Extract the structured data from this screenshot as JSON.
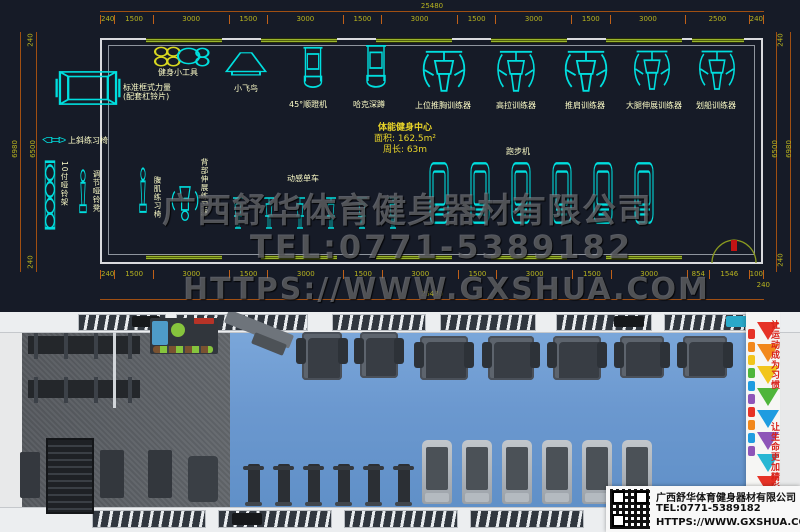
{
  "cad": {
    "dims_top": {
      "total": "25480",
      "segments": [
        "240",
        "1500",
        "3000",
        "1500",
        "3000",
        "1500",
        "3000",
        "1500",
        "3000",
        "1500",
        "3000",
        "2500",
        "240"
      ]
    },
    "dims_bottom": {
      "total": "25480",
      "segments": [
        "240",
        "1500",
        "3000",
        "1500",
        "3000",
        "1500",
        "3000",
        "1500",
        "3000",
        "1500",
        "3000",
        "854",
        "1546",
        "100"
      ],
      "corner": "240"
    },
    "dims_left": {
      "outer": "6980",
      "inner": "6500",
      "top": "240",
      "bottom": "240"
    },
    "dims_right": {
      "outer": "6980",
      "inner": "6500",
      "top": "240",
      "bottom": "240"
    },
    "center_info": {
      "name": "体能健身中心",
      "area": "面积: 162.5m²",
      "perimeter": "周长: 63m"
    },
    "equipment": {
      "top": [
        {
          "label": "标准框式力量",
          "label2": "(配套杠铃片)"
        },
        {
          "label": "健身小工具"
        },
        {
          "label": "小飞鸟"
        },
        {
          "label": "45°顺蹬机"
        },
        {
          "label": "哈克深蹲"
        },
        {
          "label": "上位推胸训练器"
        },
        {
          "label": "高拉训练器"
        },
        {
          "label": "推肩训练器"
        },
        {
          "label": "大腿伸展训练器"
        },
        {
          "label": "划船训练器"
        }
      ],
      "bottom": [
        {
          "label": "上斜练习椅"
        },
        {
          "label": "10付哑铃架"
        },
        {
          "label": "调节哑铃凳"
        },
        {
          "label": "腹肌练习椅"
        },
        {
          "label": "背部伸展练习器"
        },
        {
          "label": "动感单车"
        },
        {
          "label": "跑步机"
        }
      ]
    },
    "watermark": {
      "line1": "广西舒华体育健身器材有限公司",
      "line2": "TEL:0771-5389182",
      "line3": "HTTPS://WWW.GXSHUA.COM"
    }
  },
  "render": {
    "banner": {
      "slogan1": "让运动成为习惯",
      "slogan2": "让生命更加精彩"
    },
    "info_box": {
      "company": "广西舒华体育健身器材有限公司",
      "tel": "TEL:0771-5389182",
      "url": "HTTPS://WWW.GXSHUA.COM"
    }
  },
  "colors": {
    "cad_background": "#161b27",
    "equipment_line": "#00dede",
    "dimension_line": "#a04f12",
    "dimension_text": "#b7b31f",
    "label_text": "#fdfdc8",
    "window_strip": "#9ab52e",
    "blue_floor": "#6b98cf",
    "gray_floor": "#5c6064",
    "banner_red": "#d8231c"
  }
}
